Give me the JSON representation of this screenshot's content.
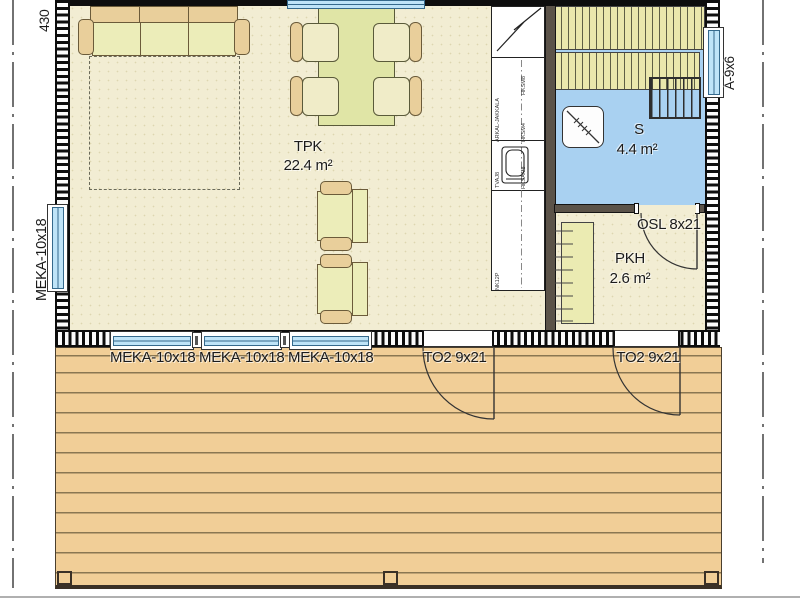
{
  "plan": {
    "dimension_top_left": "430",
    "rooms": {
      "tpk": {
        "name": "TPK",
        "area": "22.4 m²"
      },
      "sauna": {
        "name": "S",
        "area": "4.4 m²"
      },
      "pkh": {
        "name": "PKH",
        "area": "2.6 m²"
      }
    },
    "openings": {
      "window_left": "MEKA-10x18",
      "window_bottom_1": "MEKA-10x18",
      "window_bottom_2": "MEKA-10x18",
      "window_bottom_3": "MEKA-10x18",
      "window_right": "A-9x6",
      "terrace_door_left": "TO2 9x21",
      "terrace_door_right": "TO2 9x21",
      "sauna_door": "OSL 8x21"
    },
    "kitchen_unit_codes": {
      "tall_cabinet": "ARKAL-JAKKALA",
      "upper_1": "HKSM8",
      "upper_2": "HKSM4",
      "sink_left": "TVAJ8",
      "sink_right": "HKSAM8",
      "worktop": "NK12P"
    },
    "colors": {
      "floor": "#f2edd3",
      "sauna_floor": "#a9d1f1",
      "window_glass": "#bfe4f8",
      "deck": "#f1ce97",
      "furniture_light": "#ecedb9",
      "furniture_tan": "#e9cf9b",
      "bench": "#eae7ac",
      "interior_wall": "#5b5349"
    }
  }
}
